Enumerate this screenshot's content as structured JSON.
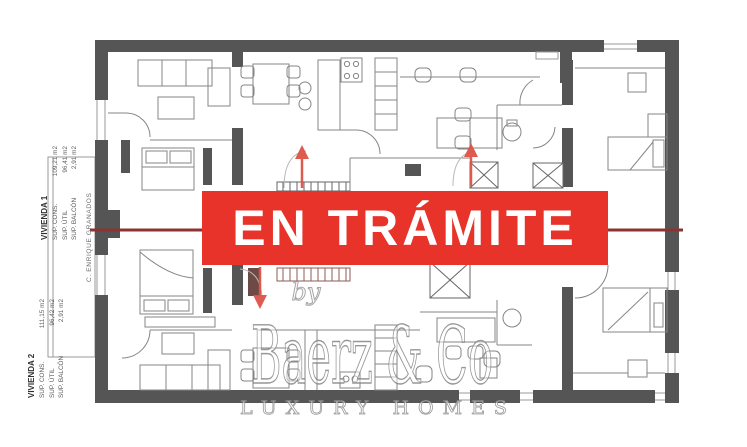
{
  "page": {
    "background": "#ffffff"
  },
  "banner": {
    "label": "EN TRÁMITE",
    "bg_color": "#e8332a",
    "text_color": "#ffffff"
  },
  "watermark": {
    "by": "by",
    "brand": "Baerz & Co",
    "tagline": "LUXURY HOMES"
  },
  "street_label": "C. ENRIQUE GRANADOS",
  "units": [
    {
      "title": "VIVIENDA 1",
      "rows": [
        {
          "label": "SUP. CONS.",
          "value": "109,21 m2"
        },
        {
          "label": "SUP. ÚTIL",
          "value": "96,41 m2"
        },
        {
          "label": "SUP. BALCÓN",
          "value": "2,91 m2"
        }
      ]
    },
    {
      "title": "VIVIENDA 2",
      "rows": [
        {
          "label": "SUP. CONS.",
          "value": "111,15 m2"
        },
        {
          "label": "SUP. ÚTIL",
          "value": "96,42 m2"
        },
        {
          "label": "SUP. BALCÓN",
          "value": "2,91 m2"
        }
      ]
    }
  ],
  "plan": {
    "section_line_color": "#8e3430",
    "arrow_color": "#dd5347",
    "wall_color": "#555555"
  }
}
